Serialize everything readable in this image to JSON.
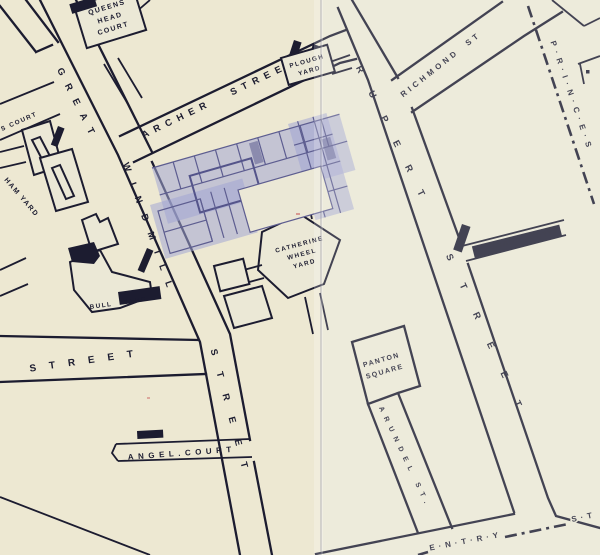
{
  "labels": {
    "queens_head_court": {
      "lines": [
        "QUEENS",
        "HEAD",
        "COURT"
      ]
    },
    "s_court": "S COURT",
    "great": "GREAT",
    "windmill": "WINDMILL",
    "windmill_street_word": "STREET",
    "archer_street": "ARCHER STREET",
    "plough_yard": {
      "lines": [
        "PLOUGH",
        "YARD"
      ]
    },
    "richmond_st": "RICHMOND ST",
    "rupert": "RUPERT",
    "rupert_street_word": "STREET",
    "princes_boundary": "P·R·I·N·C·E·S",
    "falcon_court": "FALCON COURT",
    "ham_yard": "HAM YARD",
    "bull": "BULL",
    "bull_yard_word": "YARD",
    "catherine_wheel_yard": {
      "lines": [
        "CATHERINE",
        "WHEEL",
        "YARD"
      ]
    },
    "brewer_street_word": "STREET",
    "angel_court": "ANGEL.COURT",
    "panton_square": {
      "lines": [
        "PANTON",
        "SQUARE"
      ]
    },
    "arundel_st": "ARUNDEL ST.",
    "coventry_fragment_left": "E·N·T·R·Y",
    "coventry_fragment_right": "S·T"
  },
  "colors": {
    "paper": "#ebe8d6",
    "ink": "#1c1c30",
    "overlay_fill": "#a2a6d4",
    "overlay_wall": "#5d5d90"
  }
}
